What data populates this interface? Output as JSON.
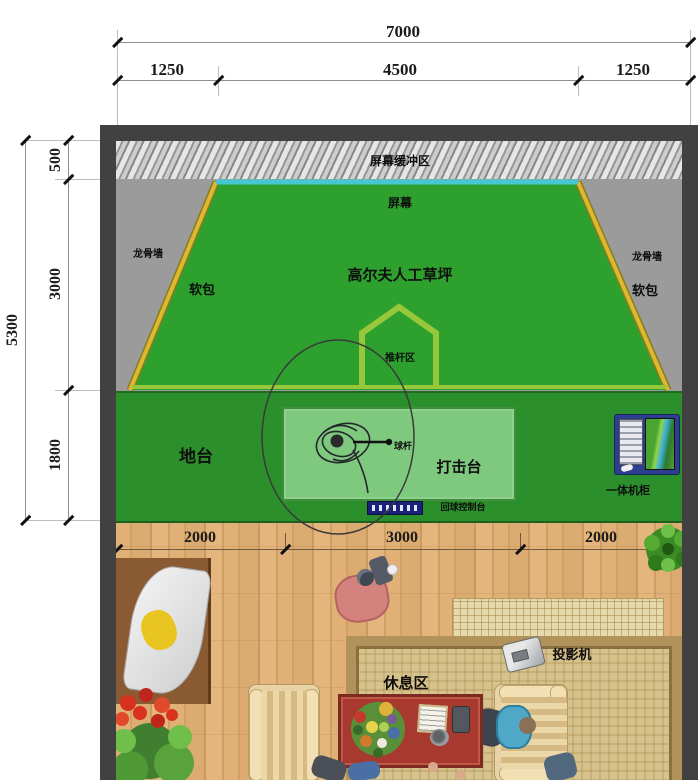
{
  "dimensions": {
    "top_total": "7000",
    "top_segments": [
      "1250",
      "4500",
      "1250"
    ],
    "left_total": "5300",
    "left_segments": [
      "500",
      "3000",
      "1800"
    ],
    "floor_segments": [
      "2000",
      "3000",
      "2000"
    ]
  },
  "labels": {
    "buffer_zone": "屏幕缓冲区",
    "screen": "屏幕",
    "turf": "高尔夫人工草坪",
    "keel_wall_left": "龙骨墙",
    "keel_wall_right": "龙骨墙",
    "soft_pad_left": "软包",
    "soft_pad_right": "软包",
    "putting_area": "推杆区",
    "platform": "地台",
    "hitting_deck": "打击台",
    "club": "球杆",
    "ball_console": "回球控制台",
    "cabinet": "一体机柜",
    "rest_area": "休息区",
    "projector": "投影机"
  },
  "colors": {
    "wall": "#414141",
    "turf_green": "#2da02d",
    "platform_green": "#2b8f2b",
    "mat_green": "#7fc97f",
    "edge_yellow": "#ddb92f",
    "screen_cyan": "#46c8d2",
    "line_light_green": "#97c83c",
    "wood": "#dcab6e",
    "table_red": "#a8392e",
    "cabinet_blue": "#2c3f8f"
  }
}
